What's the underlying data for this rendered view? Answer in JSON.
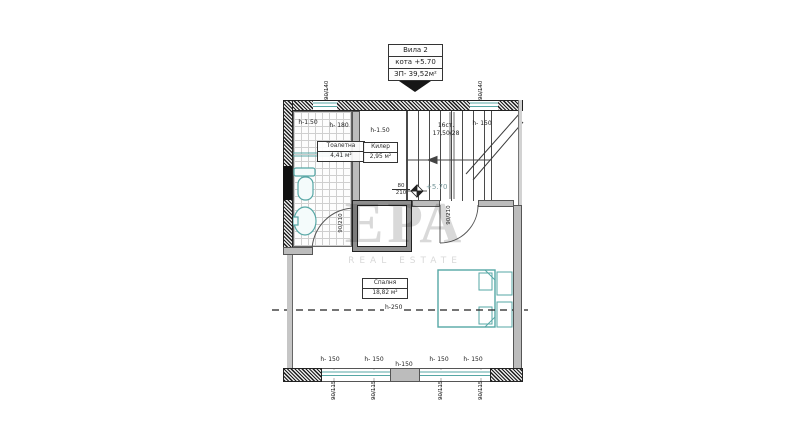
{
  "title_block": {
    "line1": "Вила 2",
    "line2": "кота +5.70",
    "line3": "ЗП- 39,52м²"
  },
  "watermark": {
    "brand": "ЕРА",
    "tagline": "REAL ESTATE"
  },
  "rooms": {
    "bathroom": {
      "name": "Тоалетна",
      "area": "4,41 м²"
    },
    "closet": {
      "name": "Килер",
      "area": "2,95 м²"
    },
    "bedroom": {
      "name": "Спалня",
      "area": "18,82 м²"
    }
  },
  "stairs": {
    "steps": "16ст.",
    "dims": "17,50/28"
  },
  "level_marker": {
    "value": "+5.70"
  },
  "doors": {
    "bath_door": {
      "num": "80",
      "den": "210"
    },
    "bath_door_side": "90/210",
    "hall_door": "90/210"
  },
  "section_line_label": "h-250",
  "sills": {
    "top": [
      "h-1.50",
      "h- 180",
      "h-1.50",
      "h- 150"
    ],
    "bottom": [
      "h- 150",
      "h- 150",
      "h-150",
      "h- 150",
      "h- 150"
    ]
  },
  "window_dims": {
    "top": [
      "90/140",
      "90/140"
    ],
    "bottom": [
      "90/115",
      "90/115",
      "90/115",
      "90/115"
    ]
  },
  "colors": {
    "teal": "#56a7a5",
    "hatch": "#1c1c1c",
    "wall_gray": "#bcbcbc",
    "watermark": "#d9d9d9",
    "line": "#333333"
  }
}
